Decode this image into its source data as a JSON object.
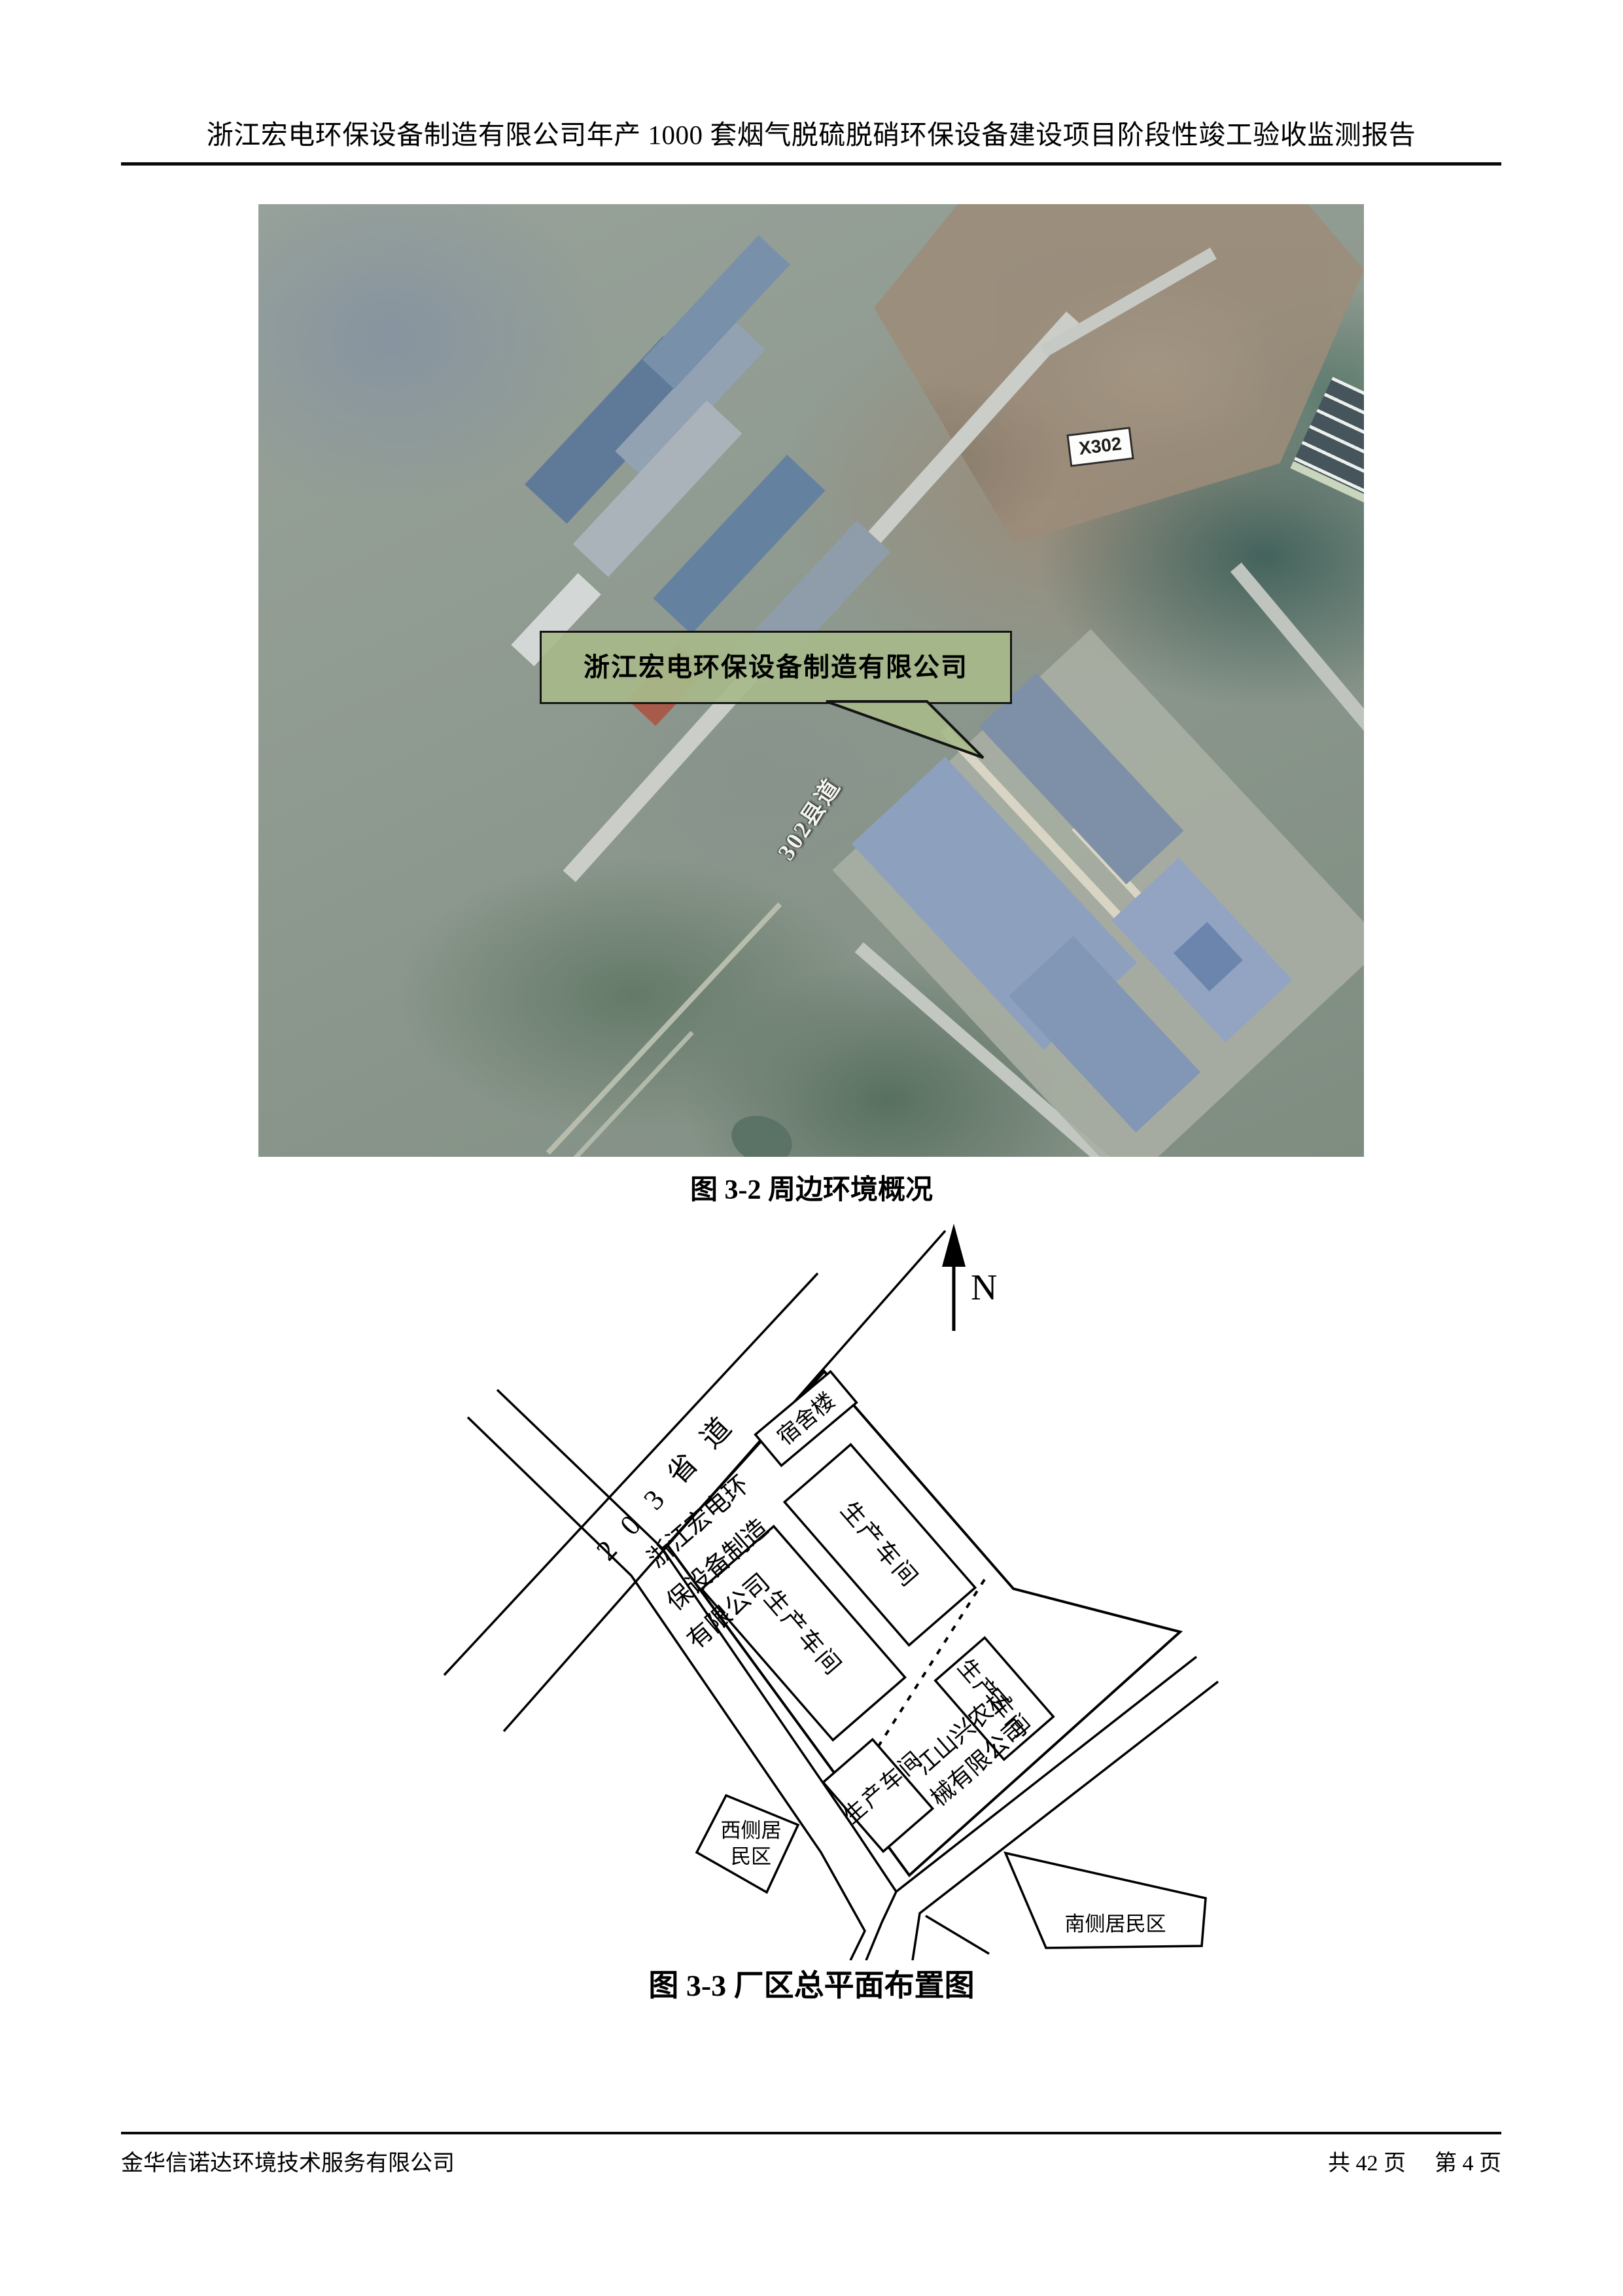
{
  "header": {
    "title": "浙江宏电环保设备制造有限公司年产 1000 套烟气脱硫脱硝环保设备建设项目阶段性竣工验收监测报告"
  },
  "figure_map": {
    "caption": "图 3-2 周边环境概况",
    "callout_label": "浙江宏电环保设备制造有限公司",
    "road_sign": "X302",
    "road_name": "302县道",
    "colors": {
      "callout_bg": "#a7ba8a",
      "terrain_base": "#8f998f",
      "factory_roof_blue": "#8da1be",
      "dirt_brown": "#9c8c7a",
      "dark_building": "#46545b"
    }
  },
  "figure_plan": {
    "caption": "图 3-3 厂区总平面布置图",
    "north_label": "N",
    "road_name": "2 0 3 省 道",
    "factory_name_lines": [
      "浙江宏电环",
      "保设备制造",
      "有限公司"
    ],
    "dorm_label": "宿舍楼",
    "workshop_label": "生产车间",
    "neighbor_company_lines": [
      "江山兴农机",
      "械有限公司"
    ],
    "west_residential_lines": [
      "西侧居",
      "民区"
    ],
    "south_residential_label": "南侧居民区"
  },
  "footer": {
    "company": "金华信诺达环境技术服务有限公司",
    "pages_total": "共 42 页",
    "page_current": "第 4 页"
  }
}
